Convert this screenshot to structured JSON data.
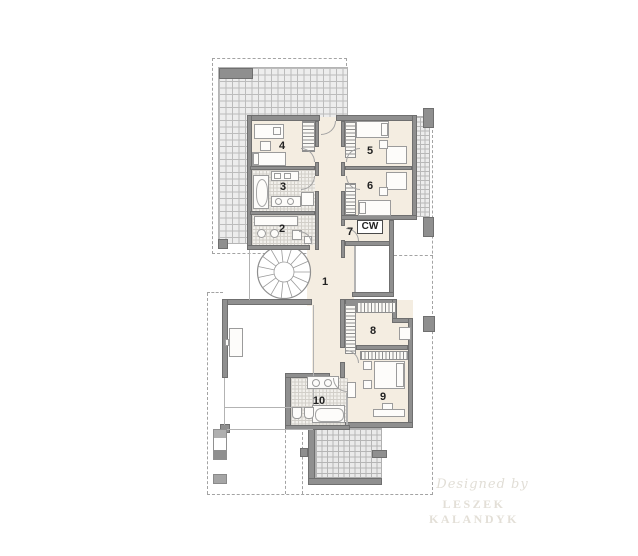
{
  "plan": {
    "room_labels": {
      "r1": "1",
      "r2": "2",
      "r3": "3",
      "r4": "4",
      "r5": "5",
      "r6": "6",
      "r7": "7",
      "r8": "8",
      "r9": "9",
      "r10": "10",
      "cw": "CW"
    },
    "watermark": {
      "credit": "Designed by",
      "author": "LESZEK KALANDYK"
    },
    "colors": {
      "floor_cream": "#f4ede1",
      "wall_gray": "#8f8f8f",
      "tile_line": "#b5b5b5",
      "dash_line": "#a3a3a3"
    }
  }
}
